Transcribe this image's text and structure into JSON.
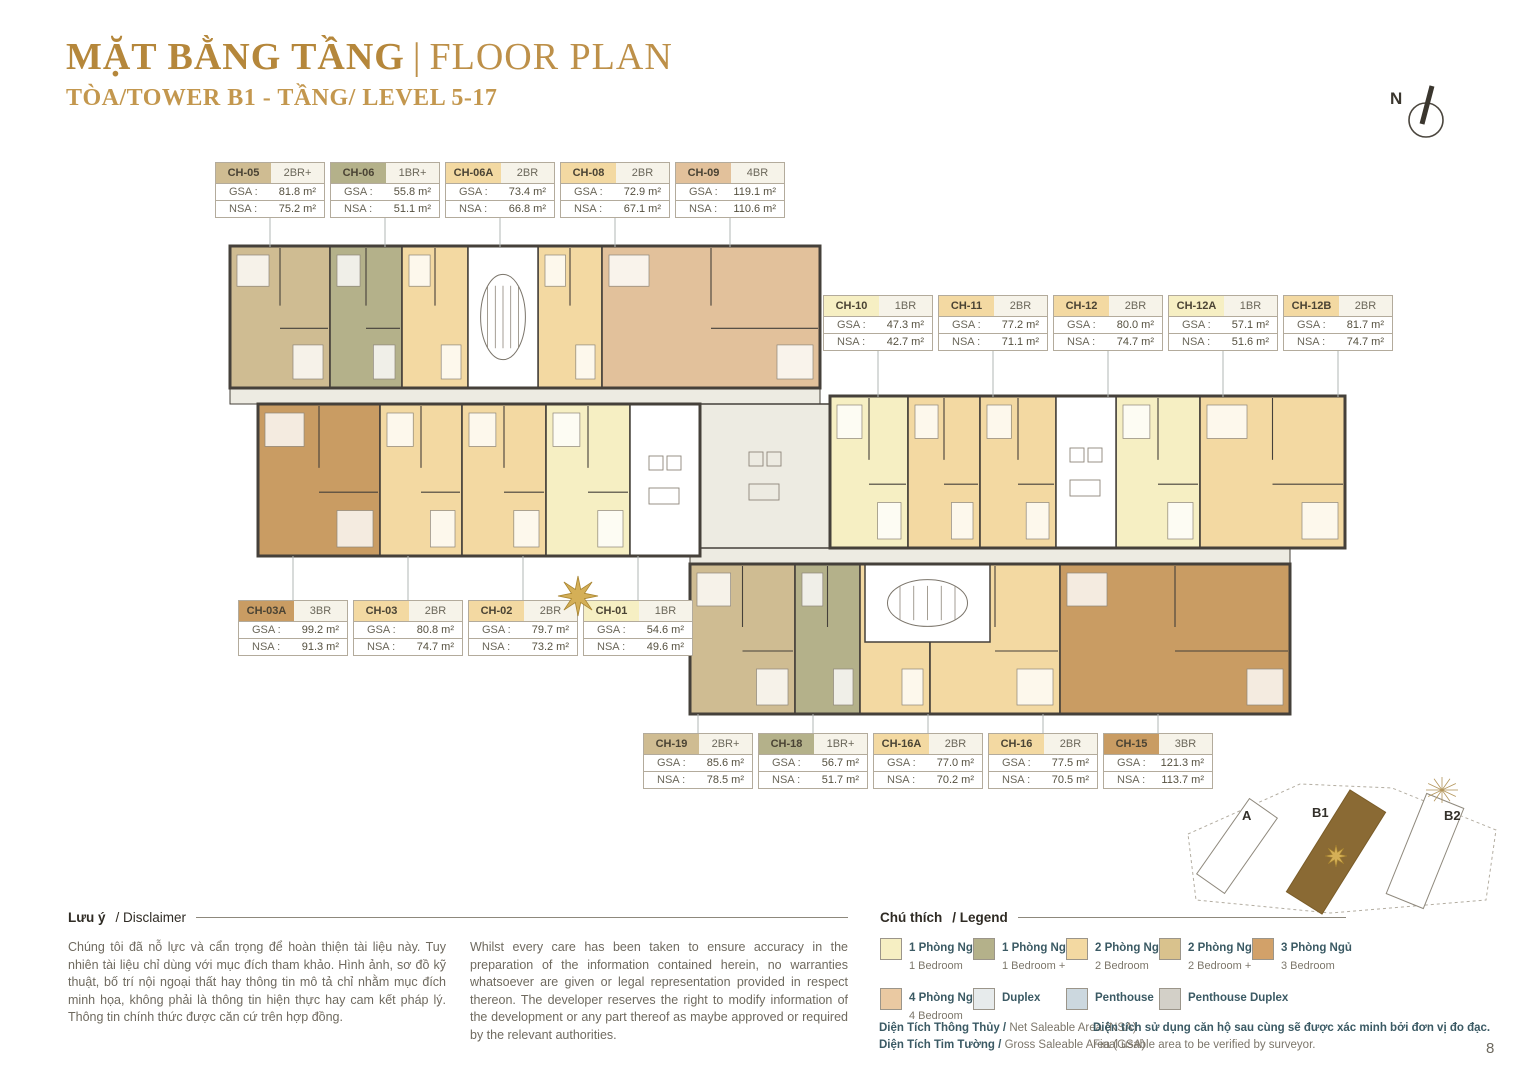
{
  "header": {
    "title_vn": "MẶT BẰNG TẦNG",
    "title_sep": "|",
    "title_en": "FLOOR PLAN",
    "subtitle": "TÒA/TOWER B1 - TẦNG/ LEVEL 5-17"
  },
  "north_label": "N",
  "labels": {
    "gsa": "GSA :",
    "nsa": "NSA :"
  },
  "cards": {
    "top": [
      {
        "code": "CH-05",
        "type": "2BR+",
        "gsa": "81.8 m²",
        "nsa": "75.2 m²",
        "color": "#cfbc92"
      },
      {
        "code": "CH-06",
        "type": "1BR+",
        "gsa": "55.8 m²",
        "nsa": "51.1 m²",
        "color": "#b4b18a"
      },
      {
        "code": "CH-06A",
        "type": "2BR",
        "gsa": "73.4 m²",
        "nsa": "66.8 m²",
        "color": "#f3d9a2"
      },
      {
        "code": "CH-08",
        "type": "2BR",
        "gsa": "72.9 m²",
        "nsa": "67.1 m²",
        "color": "#f3d9a2"
      },
      {
        "code": "CH-09",
        "type": "4BR",
        "gsa": "119.1 m²",
        "nsa": "110.6 m²",
        "color": "#e2c19b"
      }
    ],
    "right": [
      {
        "code": "CH-10",
        "type": "1BR",
        "gsa": "47.3 m²",
        "nsa": "42.7 m²",
        "color": "#f6efc3"
      },
      {
        "code": "CH-11",
        "type": "2BR",
        "gsa": "77.2 m²",
        "nsa": "71.1 m²",
        "color": "#f3d9a2"
      },
      {
        "code": "CH-12",
        "type": "2BR",
        "gsa": "80.0 m²",
        "nsa": "74.7 m²",
        "color": "#f3d9a2"
      },
      {
        "code": "CH-12A",
        "type": "1BR",
        "gsa": "57.1 m²",
        "nsa": "51.6 m²",
        "color": "#f6efc3"
      },
      {
        "code": "CH-12B",
        "type": "2BR",
        "gsa": "81.7 m²",
        "nsa": "74.7 m²",
        "color": "#f3d9a2"
      }
    ],
    "middle": [
      {
        "code": "CH-03A",
        "type": "3BR",
        "gsa": "99.2 m²",
        "nsa": "91.3 m²",
        "color": "#c99c63"
      },
      {
        "code": "CH-03",
        "type": "2BR",
        "gsa": "80.8 m²",
        "nsa": "74.7 m²",
        "color": "#f3d9a2"
      },
      {
        "code": "CH-02",
        "type": "2BR",
        "gsa": "79.7 m²",
        "nsa": "73.2 m²",
        "color": "#f3d9a2"
      },
      {
        "code": "CH-01",
        "type": "1BR",
        "gsa": "54.6 m²",
        "nsa": "49.6 m²",
        "color": "#f6efc3"
      }
    ],
    "bottom": [
      {
        "code": "CH-19",
        "type": "2BR+",
        "gsa": "85.6 m²",
        "nsa": "78.5 m²",
        "color": "#cfbc92"
      },
      {
        "code": "CH-18",
        "type": "1BR+",
        "gsa": "56.7 m²",
        "nsa": "51.7 m²",
        "color": "#b4b18a"
      },
      {
        "code": "CH-16A",
        "type": "2BR",
        "gsa": "77.0 m²",
        "nsa": "70.2 m²",
        "color": "#f3d9a2"
      },
      {
        "code": "CH-16",
        "type": "2BR",
        "gsa": "77.5 m²",
        "nsa": "70.5 m²",
        "color": "#f3d9a2"
      },
      {
        "code": "CH-15",
        "type": "3BR",
        "gsa": "121.3 m²",
        "nsa": "113.7 m²",
        "color": "#c99c63"
      }
    ]
  },
  "floor_plan": {
    "wall": "#45403a",
    "corridor": "#edebe2",
    "leader_color": "#b2b7b5",
    "units": [
      {
        "id": "CH-05",
        "x": 230,
        "y": 246,
        "w": 100,
        "h": 142,
        "color": "#cfbc92"
      },
      {
        "id": "CH-06",
        "x": 330,
        "y": 246,
        "w": 72,
        "h": 142,
        "color": "#b4b18a"
      },
      {
        "id": "CH-06A",
        "x": 402,
        "y": 246,
        "w": 66,
        "h": 142,
        "color": "#f3d9a2"
      },
      {
        "id": "CH-08",
        "x": 538,
        "y": 246,
        "w": 64,
        "h": 142,
        "color": "#f3d9a2"
      },
      {
        "id": "CH-09",
        "x": 602,
        "y": 246,
        "w": 218,
        "h": 142,
        "color": "#e2c19b"
      },
      {
        "id": "CH-03A",
        "x": 258,
        "y": 404,
        "w": 122,
        "h": 152,
        "color": "#c99c63"
      },
      {
        "id": "CH-03",
        "x": 380,
        "y": 404,
        "w": 82,
        "h": 152,
        "color": "#f3d9a2"
      },
      {
        "id": "CH-02",
        "x": 462,
        "y": 404,
        "w": 84,
        "h": 152,
        "color": "#f3d9a2"
      },
      {
        "id": "CH-01",
        "x": 546,
        "y": 404,
        "w": 84,
        "h": 152,
        "color": "#f6efc3"
      },
      {
        "id": "CH-10",
        "x": 830,
        "y": 396,
        "w": 78,
        "h": 152,
        "color": "#f6efc3"
      },
      {
        "id": "CH-11",
        "x": 908,
        "y": 396,
        "w": 72,
        "h": 152,
        "color": "#f3d9a2"
      },
      {
        "id": "CH-12",
        "x": 980,
        "y": 396,
        "w": 76,
        "h": 152,
        "color": "#f3d9a2"
      },
      {
        "id": "CH-12A",
        "x": 1116,
        "y": 396,
        "w": 84,
        "h": 152,
        "color": "#f6efc3"
      },
      {
        "id": "CH-12B",
        "x": 1200,
        "y": 396,
        "w": 145,
        "h": 152,
        "color": "#f3d9a2"
      },
      {
        "id": "CH-19",
        "x": 690,
        "y": 564,
        "w": 105,
        "h": 150,
        "color": "#cfbc92"
      },
      {
        "id": "CH-18",
        "x": 795,
        "y": 564,
        "w": 65,
        "h": 150,
        "color": "#b4b18a"
      },
      {
        "id": "CH-16A",
        "x": 860,
        "y": 564,
        "w": 70,
        "h": 150,
        "color": "#f3d9a2"
      },
      {
        "id": "CH-16",
        "x": 930,
        "y": 564,
        "w": 130,
        "h": 150,
        "color": "#f3d9a2"
      },
      {
        "id": "CH-15",
        "x": 1060,
        "y": 564,
        "w": 230,
        "h": 150,
        "color": "#c99c63"
      }
    ],
    "cores": [
      {
        "x": 468,
        "y": 246,
        "w": 70,
        "h": 142,
        "stair": true
      },
      {
        "x": 630,
        "y": 404,
        "w": 70,
        "h": 152,
        "stair": false
      },
      {
        "x": 700,
        "y": 404,
        "w": 130,
        "h": 144,
        "stair": false,
        "corridorFill": true
      },
      {
        "x": 1056,
        "y": 396,
        "w": 60,
        "h": 152,
        "stair": false
      },
      {
        "x": 865,
        "y": 564,
        "w": 125,
        "h": 78,
        "stair": true
      }
    ],
    "corridors": [
      {
        "x": 230,
        "y": 388,
        "w": 590,
        "h": 16
      },
      {
        "x": 690,
        "y": 548,
        "w": 600,
        "h": 16
      }
    ],
    "wings": [
      {
        "x": 230,
        "y": 246,
        "w": 590,
        "h": 142
      },
      {
        "x": 258,
        "y": 404,
        "w": 442,
        "h": 152
      },
      {
        "x": 830,
        "y": 396,
        "w": 515,
        "h": 152
      },
      {
        "x": 690,
        "y": 564,
        "w": 600,
        "h": 150
      }
    ],
    "leaders": {
      "top": {
        "y1": 216,
        "y2": 247,
        "xs": [
          270,
          385,
          500,
          615,
          730
        ]
      },
      "right": {
        "y1": 349,
        "y2": 397,
        "xs": [
          878,
          993,
          1108,
          1223,
          1338
        ]
      },
      "middle": {
        "y1": 556,
        "y2": 600,
        "xs": [
          293,
          408,
          523,
          638
        ]
      },
      "bottom": {
        "y1": 714,
        "y2": 733,
        "xs": [
          698,
          813,
          928,
          1043,
          1158
        ]
      }
    }
  },
  "minimap": {
    "labels": {
      "a": "A",
      "b1": "B1",
      "b2": "B2"
    },
    "b1_fill": "#8a6a34"
  },
  "disclaimer": {
    "heading_vn": "Lưu ý",
    "heading_rest": "/ Disclaimer",
    "text_vn": "Chúng tôi đã nỗ lực và cẩn trọng để hoàn thiện tài liệu này. Tuy nhiên tài liệu chỉ dùng với mục đích tham khảo. Hình ảnh, sơ đồ kỹ thuật, bố trí nội ngoại thất hay thông tin mô tả chỉ nhằm mục đích minh họa, không phải là thông tin hiện thực hay cam kết pháp lý. Thông tin chính thức được căn cứ trên hợp đồng.",
    "text_en": "Whilst every care has been taken to ensure accuracy in the preparation of the information contained herein, no warranties whatsoever are given or legal representation provided in respect thereon. The developer reserves the right to modify information of the development or any part thereof as maybe approved or required by the relevant authorities."
  },
  "legend": {
    "heading_vn": "Chú thích",
    "heading_rest": "/ Legend",
    "items": [
      {
        "vn": "1 Phòng Ngủ",
        "en": "1 Bedroom",
        "color": "#f6efc3"
      },
      {
        "vn": "1 Phòng Ngủ +",
        "en": "1 Bedroom +",
        "color": "#b4b18a"
      },
      {
        "vn": "2 Phòng Ngủ",
        "en": "2 Bedroom",
        "color": "#f3d9a2"
      },
      {
        "vn": "2 Phòng Ngủ +",
        "en": "2 Bedroom +",
        "color": "#d9c28d"
      },
      {
        "vn": "3 Phòng Ngủ",
        "en": "3 Bedroom",
        "color": "#d2a169"
      },
      {
        "vn": "4 Phòng Ngủ",
        "en": "4 Bedroom",
        "color": "#eac9a2"
      },
      {
        "vn": "Duplex",
        "en": "",
        "color": "#e7ebec"
      },
      {
        "vn": "Penthouse",
        "en": "",
        "color": "#ccd8df"
      },
      {
        "vn": "Penthouse Duplex",
        "en": "",
        "color": "#d3d0c8"
      }
    ],
    "nsa_line_vn": "Diện Tích Thông Thủy /",
    "nsa_line_en": "Net Saleable Area (NSA)",
    "gsa_line_vn": "Diện Tích Tim Tường /",
    "gsa_line_en": "Gross Saleable Area (GSA)",
    "note_vn": "Diện tích sử dụng căn hộ sau cùng sẽ được xác minh bởi đơn vị đo đạc.",
    "note_en": "Final usable area to be verified by surveyor."
  },
  "page": {
    "number": "8"
  }
}
